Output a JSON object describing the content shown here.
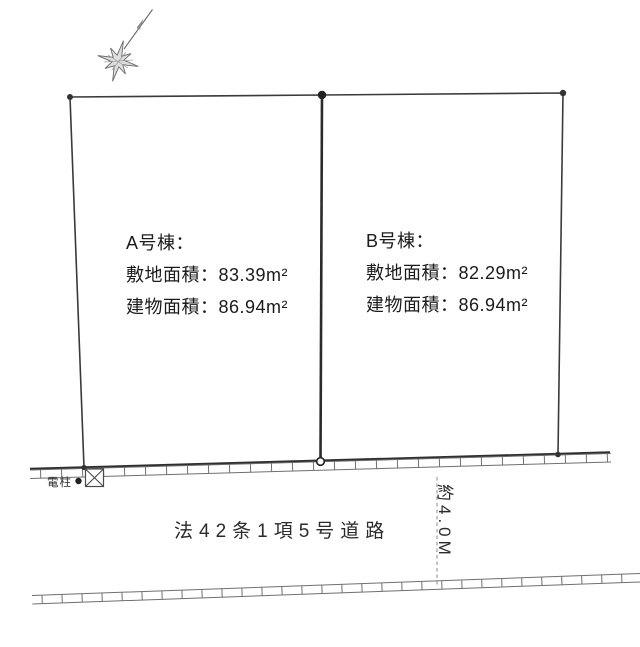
{
  "diagram_title": "land-plot-layout-diagram",
  "plots": {
    "a": {
      "title": "A号棟：",
      "land_area": "敷地面積：83.39m²",
      "building_area": "建物面積：86.94m²"
    },
    "b": {
      "title": "B号棟：",
      "land_area": "敷地面積：82.29m²",
      "building_area": "建物面積：86.94m²"
    }
  },
  "road": {
    "label": "法42条1項5号道路",
    "width_label": "約4.0M"
  },
  "utility_pole": {
    "label": "電柱"
  },
  "icons": {
    "compass": "north-arrow-icon",
    "pole_marker": "crossed-box-icon",
    "pole_dot": "pole-dot-marker"
  },
  "colors": {
    "background": "#ffffff",
    "boundary_line": "#3a3a3a",
    "divider_line": "#2b2b2b",
    "road_boundary": "#2f2f2f",
    "hatch_line": "#6f6f6f",
    "text": "#1b1b1b"
  }
}
